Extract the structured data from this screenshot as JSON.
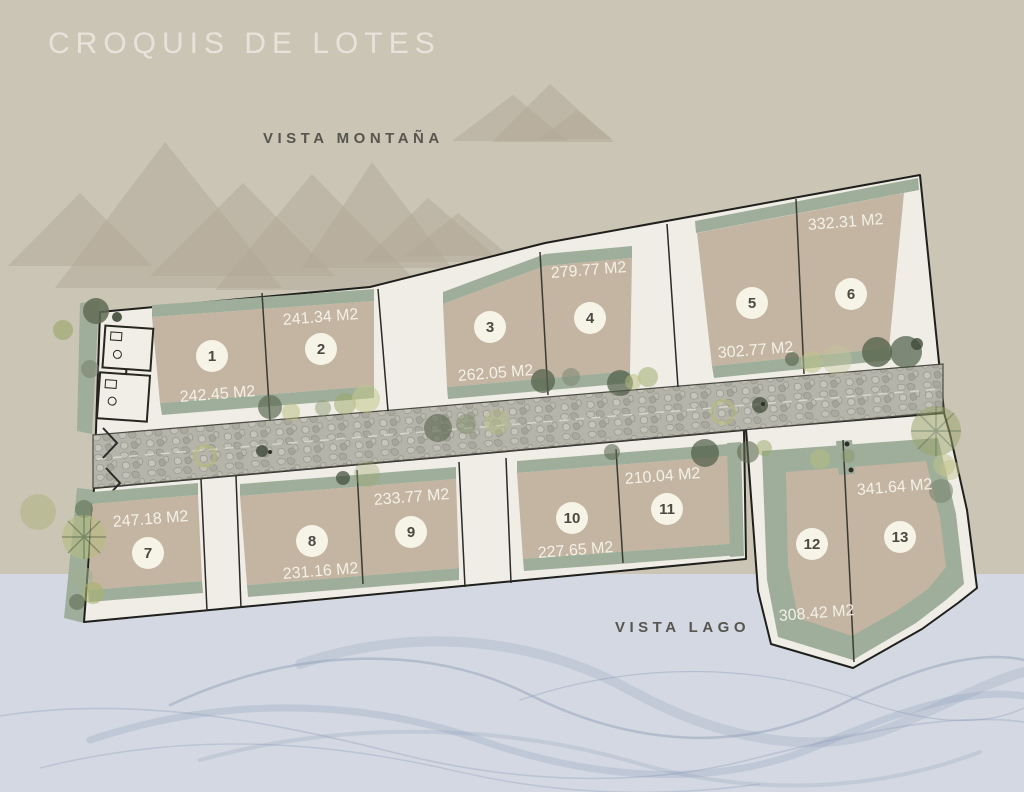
{
  "title": "CROQUIS DE LOTES",
  "labels": {
    "mountain_view": "VISTA MONTAÑA",
    "lake_view": "VISTA LAGO"
  },
  "colors": {
    "land_background": "#cbc5b6",
    "lake_background": "#d3d8e2",
    "lot_fill": "#c3b5a2",
    "green_border": "#9fae9a",
    "ground_white": "#efede6",
    "road_gray": "#b5b4aa",
    "badge_cream": "#f6f3e7",
    "outline_black": "#1f1f1c",
    "wave_blue": "#8496b2"
  },
  "lots": [
    {
      "number": "1",
      "area": "242.45 M2"
    },
    {
      "number": "2",
      "area": "241.34 M2"
    },
    {
      "number": "3",
      "area": "262.05 M2"
    },
    {
      "number": "4",
      "area": "279.77 M2"
    },
    {
      "number": "5",
      "area": "302.77 M2"
    },
    {
      "number": "6",
      "area": "332.31 M2"
    },
    {
      "number": "7",
      "area": "247.18 M2"
    },
    {
      "number": "8",
      "area": "231.16 M2"
    },
    {
      "number": "9",
      "area": "233.77 M2"
    },
    {
      "number": "10",
      "area": "227.65 M2"
    },
    {
      "number": "11",
      "area": "210.04 M2"
    },
    {
      "number": "12",
      "area": "308.42 M2"
    },
    {
      "number": "13",
      "area": "341.64 M2"
    }
  ]
}
